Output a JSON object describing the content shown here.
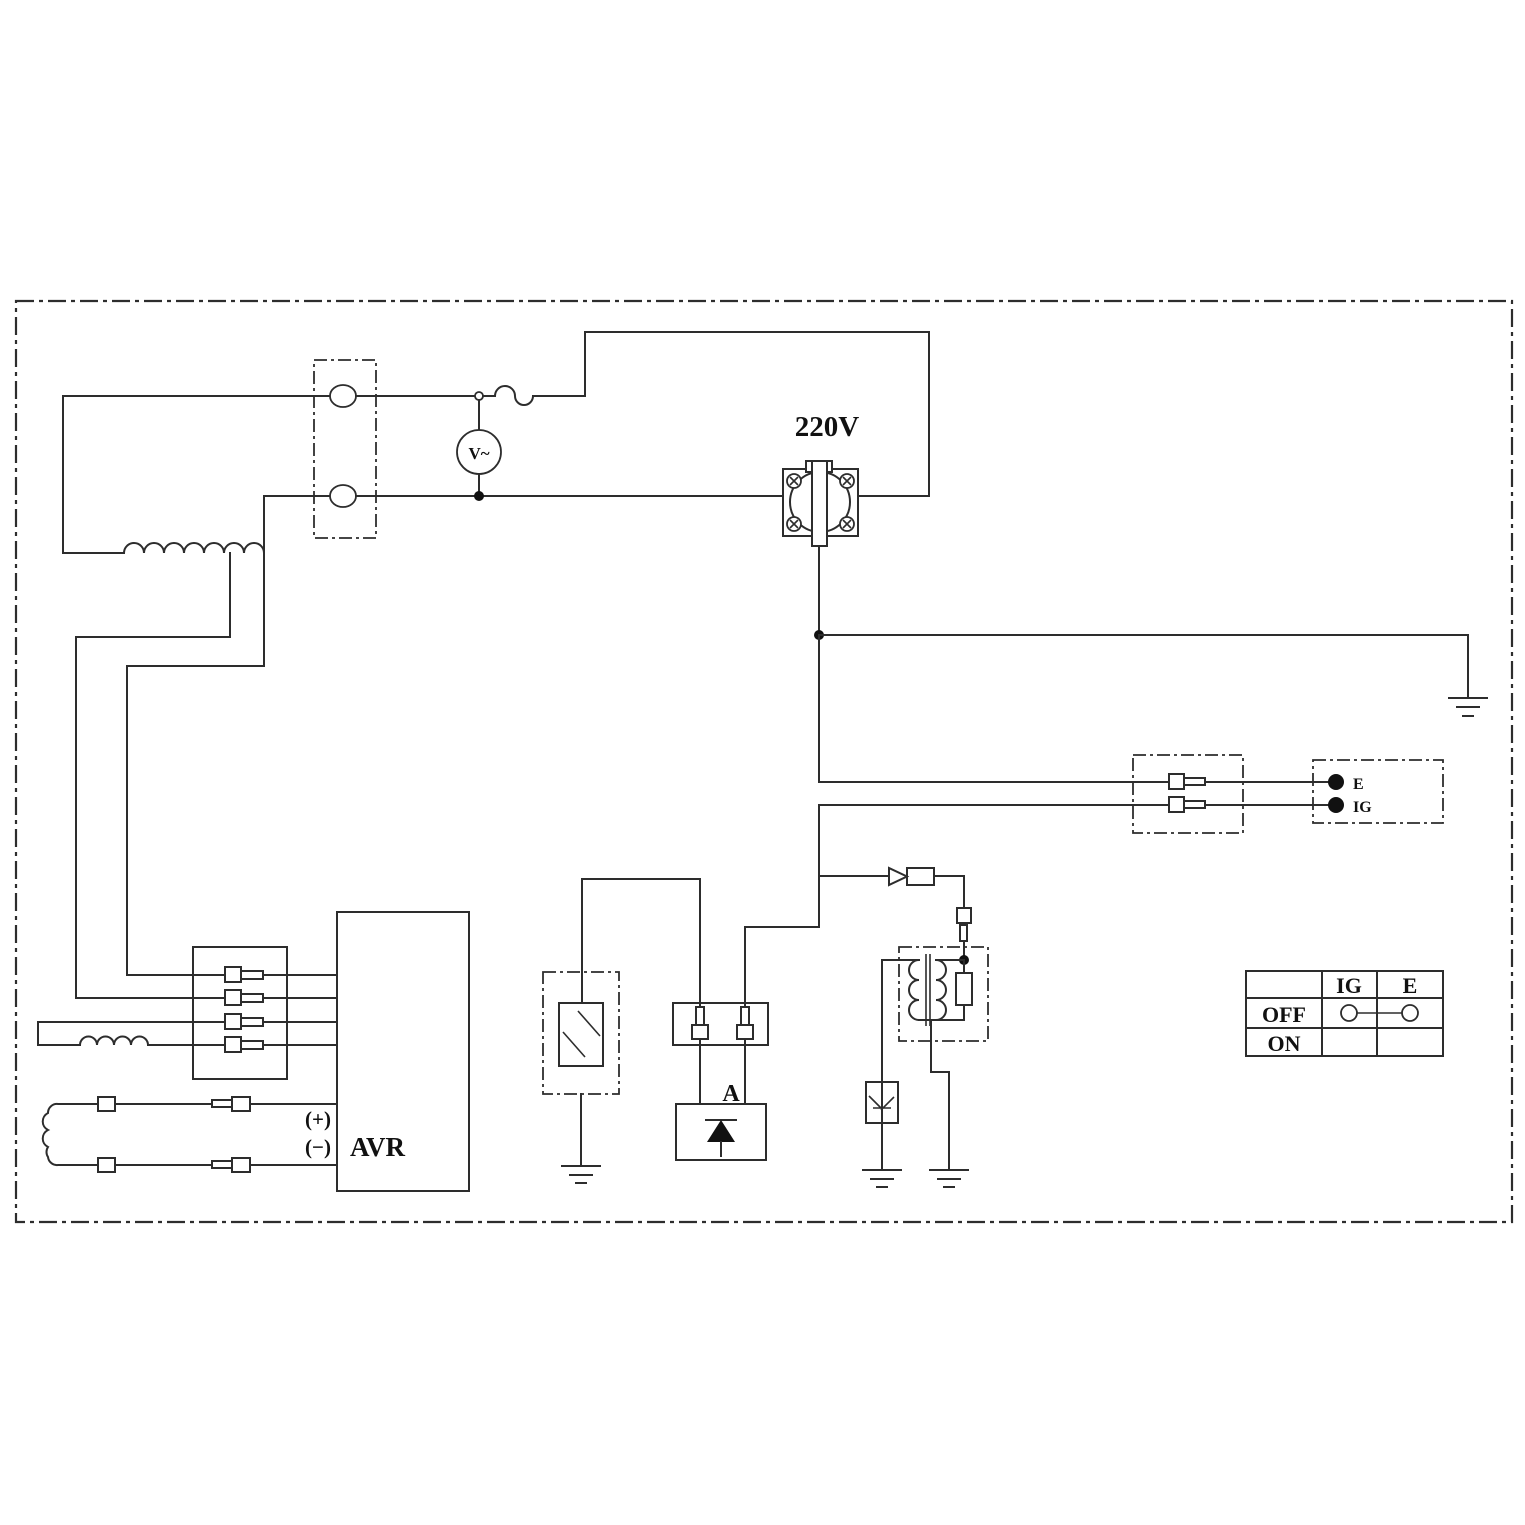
{
  "canvas": {
    "background": "#ffffff",
    "line_color": "#2d2d2d",
    "border_style": "dash-dot frame"
  },
  "labels": {
    "outlet_voltage": "220V",
    "voltmeter": "V~",
    "terminal_e": "E",
    "terminal_ig": "IG",
    "diode_unit": "A",
    "avr_name": "AVR",
    "avr_positive": "(+)",
    "avr_negative": "(−)"
  },
  "switch_table": {
    "headers": [
      "IG",
      "E"
    ],
    "rows": [
      "OFF",
      "ON"
    ],
    "off_row_connection": "IG-E bridged"
  },
  "symbols": {
    "stator_winding": "coil-7-turns",
    "sub_winding": "coil-4-turns",
    "rotor_winding": "coil-3-turns-vertical",
    "fuse": "s-curve-breaker",
    "voltmeter": "circle-V-ac",
    "receptacle_220v": "flanged-socket-4-screws",
    "ground": "earth-3-bars",
    "ignition_coil": "transformer-with-resistor",
    "spark_plug": "gap-arrow-in-box",
    "pilot_lamp_unit": "double-slash-box",
    "rectifier_a": "diode-up-filled",
    "inline_diode": "triangle-right-with-element",
    "bullet_connectors": "pin-and-socket"
  }
}
